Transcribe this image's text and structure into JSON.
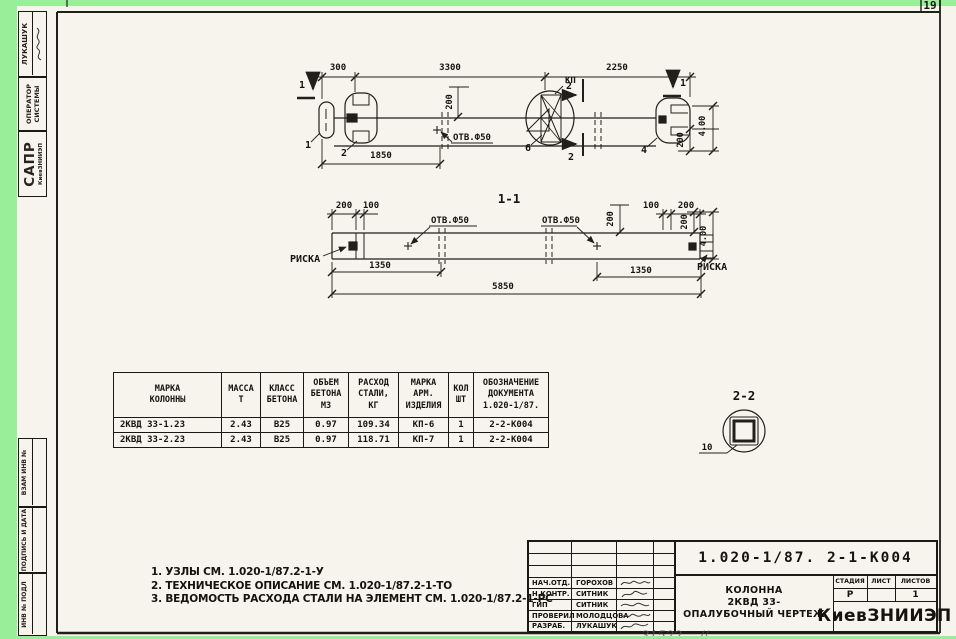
{
  "page": {
    "corner_number": "19",
    "handwritten_note": "31522 —//"
  },
  "margin_stamps": {
    "author_name": "ЛУКАШУК",
    "operator_line1": "ОПЕРАТОР",
    "operator_line2": "СИСТЕМЫ",
    "org_acronym": "САПР",
    "org_name": "КиевЗНИИЭП",
    "vzam_label": "ВЗАМ ИНВ №",
    "podpis_label": "ПОДПИСЬ И ДАТА",
    "inv_label": "ИНВ № ПОДЛ"
  },
  "plan_view": {
    "dim_300": "300",
    "dim_3300": "3300",
    "dim_2250": "2250",
    "dim_1850": "1850",
    "dim_200_hole": "200",
    "hole_label": "ОТВ.Ф50",
    "kp_label": "КП",
    "section_mark_1_left": "1",
    "section_mark_1_right": "1",
    "section_mark_2_top": "2",
    "section_mark_2_bottom": "2",
    "callout_1": "1",
    "callout_2": "2",
    "callout_6": "6",
    "callout_4": "4",
    "dim_400_right": "4.00",
    "dim_200_right": "200"
  },
  "section_1_1": {
    "title": "1-1",
    "dim_200_top_left": "200",
    "dim_100_top_left": "100",
    "hole_label_left": "ОТВ.Ф50",
    "hole_label_right": "ОТВ.Ф50",
    "riska_left": "РИСКА",
    "riska_right": "РИСКА",
    "dim_1350_left": "1350",
    "dim_1350_right": "1350",
    "dim_5850": "5850",
    "dim_200_mid": "200",
    "dim_100_top_right": "100",
    "dim_200_top_right": "200",
    "dim_200_right": "200",
    "dim_400_right": "4.00"
  },
  "section_2_2": {
    "title": "2-2",
    "callout_10": "10"
  },
  "table": {
    "headers": [
      [
        "МАРКА",
        "КОЛОННЫ"
      ],
      [
        "МАССА",
        "Т"
      ],
      [
        "КЛАСС",
        "БЕТОНА"
      ],
      [
        "ОБЪЕМ",
        "БЕТОНА",
        "М3"
      ],
      [
        "РАСХОД",
        "СТАЛИ,",
        "КГ"
      ],
      [
        "МАРКА",
        "АРМ.",
        "ИЗДЕЛИЯ"
      ],
      [
        "КОЛ",
        "ШТ"
      ],
      [
        "ОБОЗНАЧЕНИЕ",
        "ДОКУМЕНТА",
        "1.020-1/87."
      ]
    ],
    "rows": [
      [
        "2КВД 33-1.23",
        "2.43",
        "В25",
        "0.97",
        "109.34",
        "КП-6",
        "1",
        "2-2-К004"
      ],
      [
        "2КВД 33-2.23",
        "2.43",
        "В25",
        "0.97",
        "118.71",
        "КП-7",
        "1",
        "2-2-К004"
      ]
    ]
  },
  "notes": [
    "1. УЗЛЫ СМ. 1.020-1/87.2-1-У",
    "2. ТЕХНИЧЕСКОЕ ОПИСАНИЕ СМ. 1.020-1/87.2-1-ТО",
    "3. ВЕДОМОСТЬ РАСХОДА СТАЛИ НА ЭЛЕМЕНТ СМ. 1.020-1/87.2-1-РС"
  ],
  "title_block": {
    "document_number": "1.020-1/87. 2-1-К004",
    "people": [
      {
        "role": "НАЧ.ОТД.",
        "name": "ГОРОХОВ"
      },
      {
        "role": "Н.КОНТР.",
        "name": "СИТНИК"
      },
      {
        "role": "ГИП",
        "name": "СИТНИК"
      },
      {
        "role": "ПРОВЕРИЛ",
        "name": "МОЛОДЦОВА"
      },
      {
        "role": "РАЗРАБ.",
        "name": "ЛУКАШУК"
      }
    ],
    "title_lines": [
      "КОЛОННА",
      "2КВД 33-",
      "ОПАЛУБОЧНЫЙ ЧЕРТЕЖ"
    ],
    "stage_header": "СТАДИЯ",
    "sheet_header": "ЛИСТ",
    "sheets_header": "ЛИСТОВ",
    "stage_value": "Р",
    "sheets_value": "1",
    "organization": "КиевЗНИИЭП"
  }
}
